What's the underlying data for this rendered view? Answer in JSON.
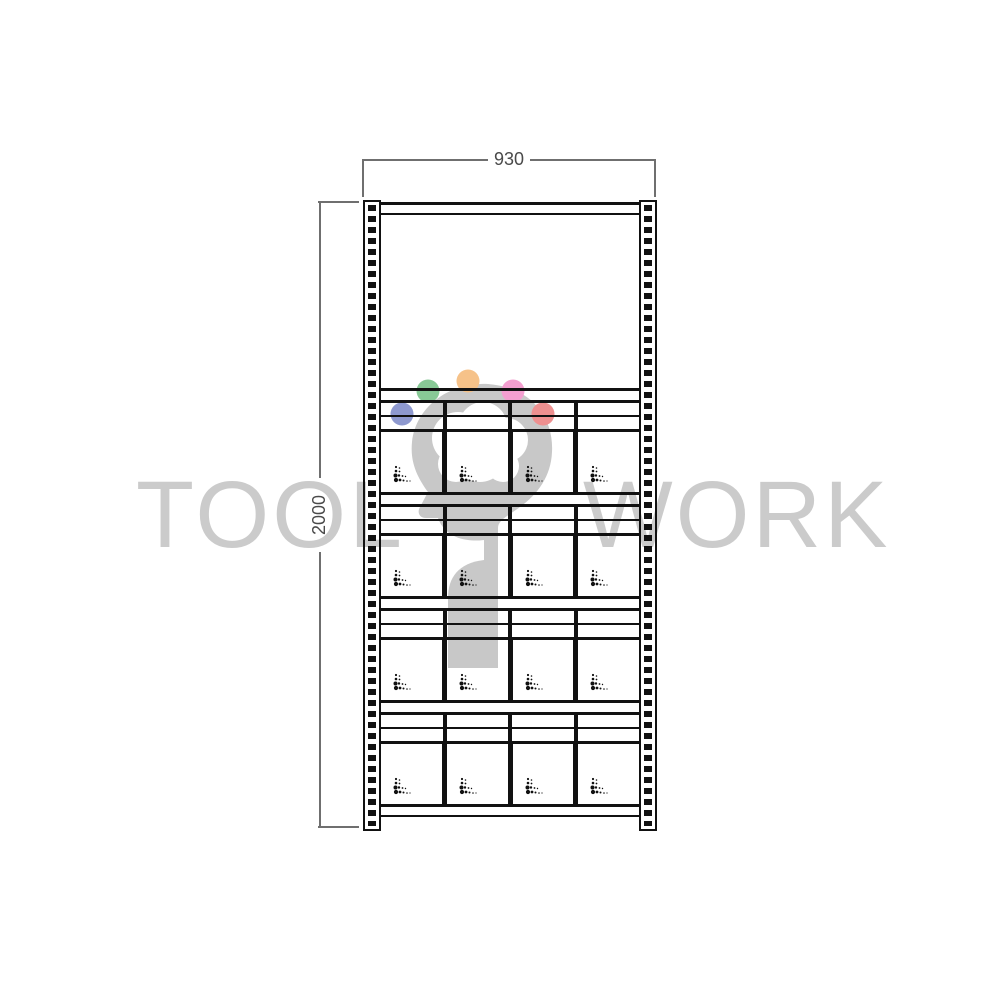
{
  "drawing": {
    "type": "shelving-unit-front-elevation",
    "dimensions": {
      "width_label": "930",
      "height_label": "2000"
    },
    "structure": {
      "shelf_modules": 4,
      "bins_per_row": 4,
      "rail_rows_per_module": 2,
      "bin_mark_icon": "scatter-dots-mark",
      "upright_icon": "perforated-upright"
    },
    "colors": {
      "line": "#111111",
      "dimension_line": "#6f6f6f",
      "dimension_text": "#4a4a4a"
    }
  },
  "watermark": {
    "left_text": "TOOL",
    "right_text": "WORK",
    "text_color": "#cbcbcb",
    "logo": {
      "icon": "head-profile-logo",
      "head_color": "#c8c8c8",
      "dot_colors": [
        "#8e99cf",
        "#88c996",
        "#f6c289",
        "#f49fd0",
        "#ee9090"
      ]
    }
  }
}
